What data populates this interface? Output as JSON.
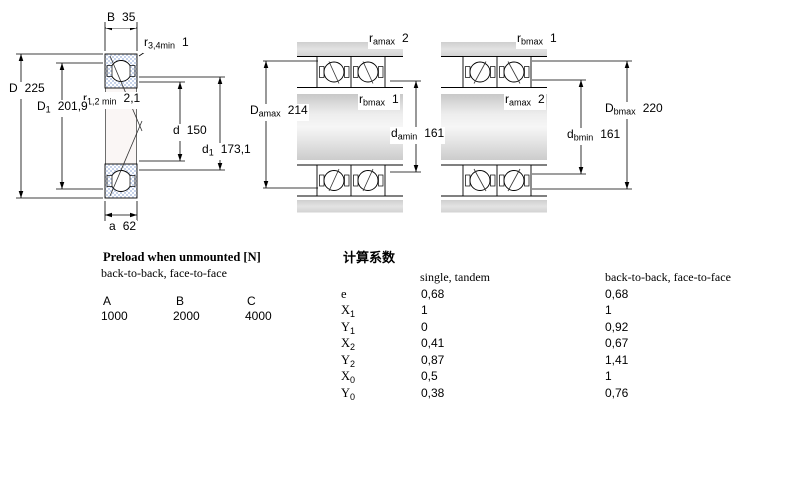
{
  "diagram_left": {
    "labels": {
      "B": {
        "main": "B",
        "sub": "",
        "value": "35"
      },
      "r34min": {
        "main": "r",
        "sub": "3,4min",
        "value": "1"
      },
      "D": {
        "main": "D",
        "sub": "",
        "value": "225"
      },
      "r12min": {
        "main": "r",
        "sub": "1,2 min",
        "value": "2,1"
      },
      "D1": {
        "main": "D",
        "sub": "1",
        "value": "201,9"
      },
      "d": {
        "main": "d",
        "sub": "",
        "value": "150"
      },
      "d1": {
        "main": "d",
        "sub": "1",
        "value": "173,1"
      },
      "a": {
        "main": "a",
        "sub": "",
        "value": "62"
      }
    }
  },
  "diagram_middle": {
    "labels": {
      "ramax": {
        "main": "r",
        "sub": "amax",
        "value": "2"
      },
      "Damax": {
        "main": "D",
        "sub": "amax",
        "value": "214"
      },
      "rbmax": {
        "main": "r",
        "sub": "bmax",
        "value": "1"
      },
      "damin": {
        "main": "d",
        "sub": "amin",
        "value": "161"
      }
    }
  },
  "diagram_right": {
    "labels": {
      "rbmax": {
        "main": "r",
        "sub": "bmax",
        "value": "1"
      },
      "Dbmax": {
        "main": "D",
        "sub": "bmax",
        "value": "220"
      },
      "ramax": {
        "main": "r",
        "sub": "amax",
        "value": "2"
      },
      "dbmin": {
        "main": "d",
        "sub": "bmin",
        "value": "161"
      }
    }
  },
  "colors": {
    "bearing_hatch": "#c7d3ea",
    "housing_gray": "#d8d8d8",
    "line": "#000000"
  },
  "preload": {
    "title": "Preload when unmounted [N]",
    "subtitle": "back-to-back, face-to-face",
    "columns": [
      "A",
      "B",
      "C"
    ],
    "values": [
      "1000",
      "2000",
      "4000"
    ]
  },
  "factors": {
    "title": "计算系数",
    "col_single": "single, tandem",
    "col_btb": "back-to-back, face-to-face",
    "rows": [
      {
        "label": {
          "main": "e",
          "sub": ""
        },
        "single": "0,68",
        "btb": "0,68"
      },
      {
        "label": {
          "main": "X",
          "sub": "1"
        },
        "single": "1",
        "btb": "1"
      },
      {
        "label": {
          "main": "Y",
          "sub": "1"
        },
        "single": "0",
        "btb": "0,92"
      },
      {
        "label": {
          "main": "X",
          "sub": "2"
        },
        "single": "0,41",
        "btb": "0,67"
      },
      {
        "label": {
          "main": "Y",
          "sub": "2"
        },
        "single": "0,87",
        "btb": "1,41"
      },
      {
        "label": {
          "main": "X",
          "sub": "0"
        },
        "single": "0,5",
        "btb": "1"
      },
      {
        "label": {
          "main": "Y",
          "sub": "0"
        },
        "single": "0,38",
        "btb": "0,76"
      }
    ]
  }
}
